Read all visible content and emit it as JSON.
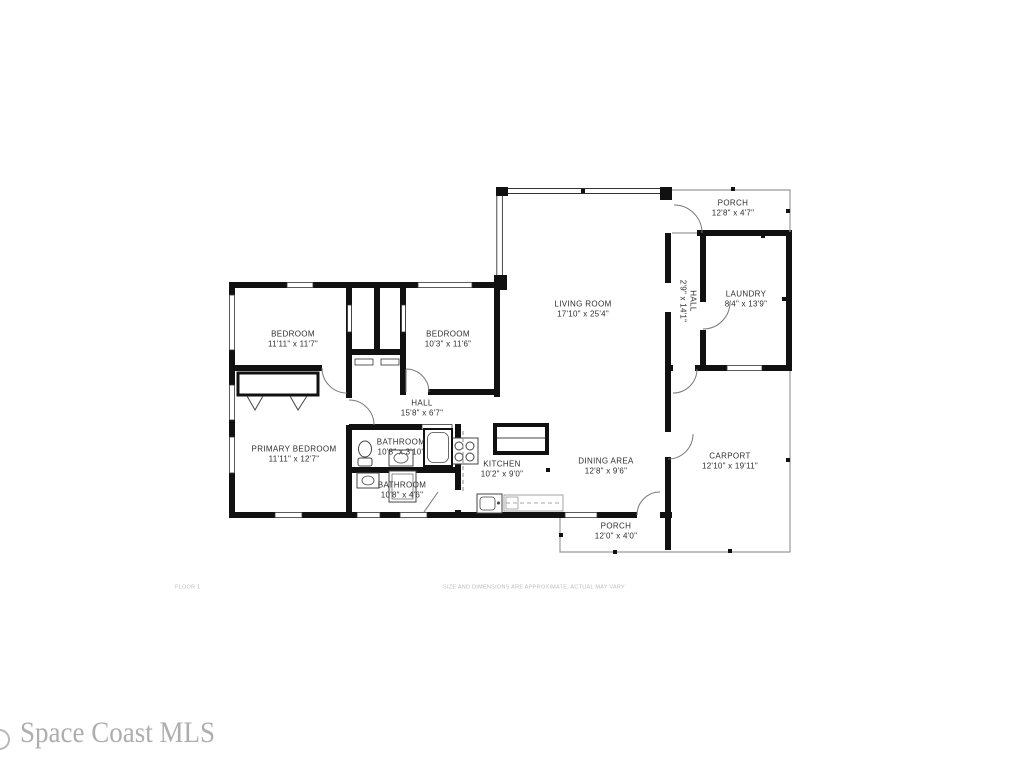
{
  "plan": {
    "rooms": [
      {
        "id": "porch-upper",
        "name": "PORCH",
        "dims": "12'8\" x 4'7\""
      },
      {
        "id": "laundry",
        "name": "LAUNDRY",
        "dims": "8'4\" x 13'9\""
      },
      {
        "id": "hall-upper",
        "name": "HALL",
        "dims": "2'9\" x 14'1\""
      },
      {
        "id": "living-room",
        "name": "LIVING ROOM",
        "dims": "17'10\" x 25'4\""
      },
      {
        "id": "bedroom-1",
        "name": "BEDROOM",
        "dims": "11'11\" x 11'7\""
      },
      {
        "id": "bedroom-2",
        "name": "BEDROOM",
        "dims": "10'3\" x 11'6\""
      },
      {
        "id": "hall",
        "name": "HALL",
        "dims": "15'8\" x 6'7\""
      },
      {
        "id": "primary-bedroom",
        "name": "PRIMARY BEDROOM",
        "dims": "11'11\" x 12'7\""
      },
      {
        "id": "bathroom-1",
        "name": "BATHROOM",
        "dims": "10'8\" x 3'10\""
      },
      {
        "id": "bathroom-2",
        "name": "BATHROOM",
        "dims": "10'8\" x 4'6\""
      },
      {
        "id": "kitchen",
        "name": "KITCHEN",
        "dims": "10'2\" x 9'0\""
      },
      {
        "id": "dining-area",
        "name": "DINING AREA",
        "dims": "12'8\" x 9'6\""
      },
      {
        "id": "carport",
        "name": "CARPORT",
        "dims": "12'10\" x 19'11\""
      },
      {
        "id": "porch-lower",
        "name": "PORCH",
        "dims": "12'0\" x 4'0\""
      }
    ]
  },
  "footer": {
    "floor_label": "FLOOR 1",
    "disclaimer": "SIZE AND DIMENSIONS ARE APPROXIMATE, ACTUAL MAY VARY"
  },
  "watermark": {
    "text": "Space Coast MLS"
  },
  "colors": {
    "wall": "#111111",
    "thin_outline": "#999999",
    "label_text": "#2e2e2e",
    "footer_text": "#bcbcbc",
    "watermark_text": "#aeaeae",
    "background": "#ffffff"
  }
}
